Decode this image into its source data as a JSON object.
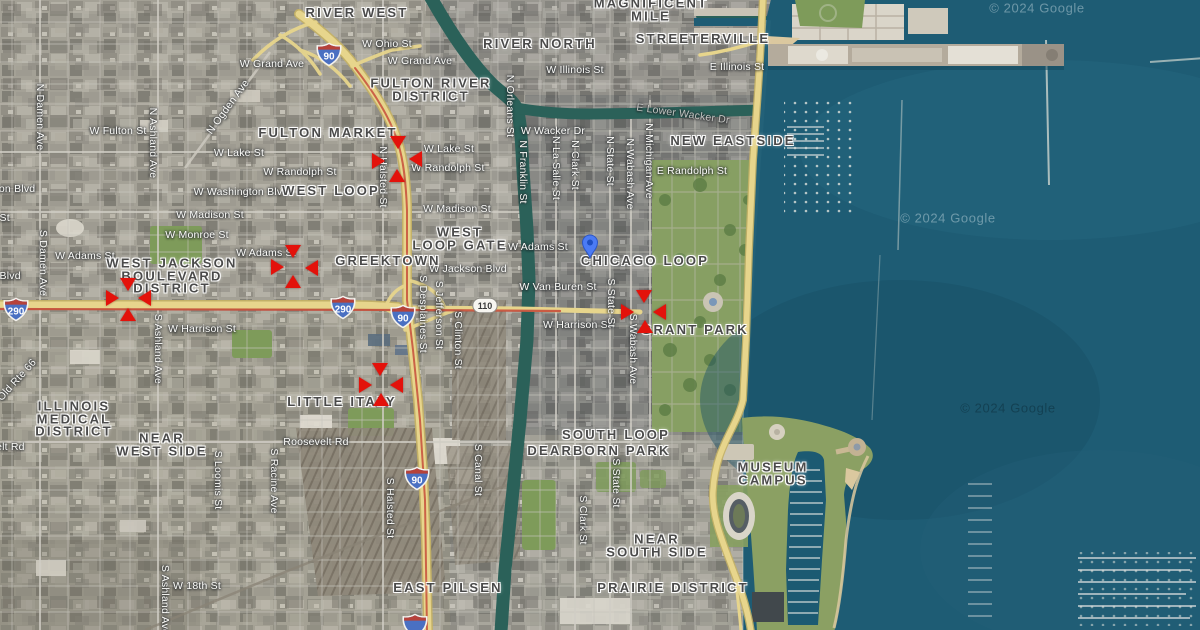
{
  "map": {
    "marker_color": "#e3120b",
    "pin": {
      "x": 590,
      "y": 258,
      "color": "#4b7bf5"
    },
    "watermarks": [
      {
        "text": "© 2024 Google",
        "x": 948,
        "y": 218,
        "tone": "light"
      },
      {
        "text": "© 2024 Google",
        "x": 1008,
        "y": 408,
        "tone": "dark"
      },
      {
        "text": "© 2024 Google",
        "x": 1037,
        "y": 8,
        "tone": "light"
      }
    ],
    "neighborhoods": [
      {
        "lines": [
          "RIVER WEST"
        ],
        "x": 357,
        "y": 13
      },
      {
        "lines": [
          "MAGNIFICENT",
          "MILE"
        ],
        "x": 651,
        "y": 10
      },
      {
        "lines": [
          "RIVER NORTH"
        ],
        "x": 540,
        "y": 44
      },
      {
        "lines": [
          "STREETERVILLE"
        ],
        "x": 703,
        "y": 39
      },
      {
        "lines": [
          "FULTON RIVER",
          "DISTRICT"
        ],
        "x": 431,
        "y": 90
      },
      {
        "lines": [
          "FULTON MARKET"
        ],
        "x": 328,
        "y": 133
      },
      {
        "lines": [
          "NEW EASTSIDE"
        ],
        "x": 733,
        "y": 141
      },
      {
        "lines": [
          "WEST LOOP"
        ],
        "x": 331,
        "y": 191
      },
      {
        "lines": [
          "WEST",
          "LOOP GATE"
        ],
        "x": 460,
        "y": 239
      },
      {
        "lines": [
          "CHICAGO LOOP"
        ],
        "x": 645,
        "y": 261
      },
      {
        "lines": [
          "GREEKTOWN"
        ],
        "x": 388,
        "y": 261
      },
      {
        "lines": [
          "WEST JACKSON",
          "BOULEVARD",
          "DISTRICT"
        ],
        "x": 172,
        "y": 276
      },
      {
        "lines": [
          "GRANT PARK"
        ],
        "x": 695,
        "y": 330
      },
      {
        "lines": [
          "ILLINOIS",
          "MEDICAL",
          "DISTRICT"
        ],
        "x": 74,
        "y": 419
      },
      {
        "lines": [
          "NEAR",
          "WEST SIDE"
        ],
        "x": 162,
        "y": 445
      },
      {
        "lines": [
          "LITTLE ITALY"
        ],
        "x": 342,
        "y": 402
      },
      {
        "lines": [
          "SOUTH LOOP"
        ],
        "x": 616,
        "y": 435
      },
      {
        "lines": [
          "DEARBORN PARK"
        ],
        "x": 599,
        "y": 451
      },
      {
        "lines": [
          "MUSEUM",
          "CAMPUS"
        ],
        "x": 773,
        "y": 474
      },
      {
        "lines": [
          "NEAR",
          "SOUTH SIDE"
        ],
        "x": 657,
        "y": 546
      },
      {
        "lines": [
          "EAST PILSEN"
        ],
        "x": 448,
        "y": 588
      },
      {
        "lines": [
          "PRAIRIE DISTRICT"
        ],
        "x": 673,
        "y": 588
      }
    ],
    "streets": [
      {
        "name": "W Ohio St",
        "x": 387,
        "y": 44
      },
      {
        "name": "W Grand Ave",
        "x": 272,
        "y": 64
      },
      {
        "name": "W Grand Ave",
        "x": 420,
        "y": 61
      },
      {
        "name": "W Illinois St",
        "x": 575,
        "y": 70
      },
      {
        "name": "E Illinois St",
        "x": 737,
        "y": 67
      },
      {
        "name": "W Wacker Dr",
        "x": 553,
        "y": 131
      },
      {
        "name": "E Lower Wacker Dr",
        "x": 683,
        "y": 114,
        "rot": 8,
        "dim": true
      },
      {
        "name": "E Randolph St",
        "x": 692,
        "y": 171
      },
      {
        "name": "W Fulton St",
        "x": 118,
        "y": 131
      },
      {
        "name": "W Lake St",
        "x": 239,
        "y": 153
      },
      {
        "name": "W Lake St",
        "x": 449,
        "y": 149
      },
      {
        "name": "W Randolph St",
        "x": 300,
        "y": 172
      },
      {
        "name": "W Randolph St",
        "x": 448,
        "y": 168
      },
      {
        "name": "W Washington Blvd",
        "x": 241,
        "y": 192
      },
      {
        "name": "W Washington Blvd",
        "x": -12,
        "y": 189
      },
      {
        "name": "W Madison St",
        "x": 210,
        "y": 215
      },
      {
        "name": "W Madison St",
        "x": 457,
        "y": 209
      },
      {
        "name": "W Madison St",
        "x": -24,
        "y": 218
      },
      {
        "name": "W Monroe St",
        "x": 197,
        "y": 235
      },
      {
        "name": "W Adams St",
        "x": 85,
        "y": 256
      },
      {
        "name": "W Adams St",
        "x": 266,
        "y": 253
      },
      {
        "name": "W Adams St",
        "x": 538,
        "y": 247
      },
      {
        "name": "W Jackson Blvd",
        "x": 468,
        "y": 269
      },
      {
        "name": "W Jackson Blvd",
        "x": -18,
        "y": 276
      },
      {
        "name": "W Van Buren St",
        "x": 558,
        "y": 287
      },
      {
        "name": "W Harrison St",
        "x": 202,
        "y": 329
      },
      {
        "name": "W Harrison St",
        "x": 577,
        "y": 325
      },
      {
        "name": "Roosevelt Rd",
        "x": 316,
        "y": 442
      },
      {
        "name": "Roosevelt Rd",
        "x": -8,
        "y": 447
      },
      {
        "name": "W 18th St",
        "x": 197,
        "y": 586
      },
      {
        "name": "N Damen Ave",
        "x": 40,
        "y": 117,
        "rot": 90
      },
      {
        "name": "S Damen Ave",
        "x": 43,
        "y": 263,
        "rot": 90
      },
      {
        "name": "N Ashland Ave",
        "x": 153,
        "y": 143,
        "rot": 90
      },
      {
        "name": "S Ashland Ave",
        "x": 158,
        "y": 349,
        "rot": 90
      },
      {
        "name": "S Ashland Ave",
        "x": 165,
        "y": 600,
        "rot": 90
      },
      {
        "name": "S Loomis St",
        "x": 218,
        "y": 480,
        "rot": 90
      },
      {
        "name": "S Racine Ave",
        "x": 274,
        "y": 481,
        "rot": 90
      },
      {
        "name": "N Halsted St",
        "x": 383,
        "y": 177,
        "rot": 90
      },
      {
        "name": "S Halsted St",
        "x": 390,
        "y": 508,
        "rot": 90
      },
      {
        "name": "S Desplaines St",
        "x": 423,
        "y": 314,
        "rot": 90
      },
      {
        "name": "S Jefferson St",
        "x": 439,
        "y": 315,
        "rot": 90
      },
      {
        "name": "S Clinton St",
        "x": 458,
        "y": 340,
        "rot": 90
      },
      {
        "name": "S Canal St",
        "x": 478,
        "y": 470,
        "rot": 90
      },
      {
        "name": "N Orleans St",
        "x": 510,
        "y": 106,
        "rot": 90
      },
      {
        "name": "N Franklin St",
        "x": 523,
        "y": 172,
        "rot": 90
      },
      {
        "name": "N La Salle St",
        "x": 556,
        "y": 168,
        "rot": 90
      },
      {
        "name": "N Clark St",
        "x": 575,
        "y": 165,
        "rot": 90
      },
      {
        "name": "N State St",
        "x": 610,
        "y": 161,
        "rot": 90
      },
      {
        "name": "N Wabash Ave",
        "x": 630,
        "y": 174,
        "rot": 90
      },
      {
        "name": "N Michigan Ave",
        "x": 649,
        "y": 161,
        "rot": 90
      },
      {
        "name": "S State St",
        "x": 611,
        "y": 303,
        "rot": 90
      },
      {
        "name": "S Wabash Ave",
        "x": 633,
        "y": 349,
        "rot": 90
      },
      {
        "name": "S State St",
        "x": 616,
        "y": 483,
        "rot": 90
      },
      {
        "name": "S Clark St",
        "x": 583,
        "y": 520,
        "rot": 90
      },
      {
        "name": "N Ogden Ave",
        "x": 228,
        "y": 107,
        "rot": -54
      },
      {
        "name": "Old Rte 66",
        "x": 17,
        "y": 380,
        "rot": -48
      }
    ],
    "highway_shields": [
      {
        "type": "interstate",
        "label": "90",
        "x": 329,
        "y": 57
      },
      {
        "type": "interstate",
        "label": "290",
        "x": 16,
        "y": 312
      },
      {
        "type": "interstate",
        "label": "290",
        "x": 343,
        "y": 310
      },
      {
        "type": "interstate",
        "label": "90",
        "x": 403,
        "y": 319
      },
      {
        "type": "state",
        "label": "110",
        "x": 485,
        "y": 308
      },
      {
        "type": "interstate",
        "label": "90",
        "x": 417,
        "y": 481
      },
      {
        "type": "interstate",
        "label": "",
        "x": 415,
        "y": 628
      }
    ],
    "incident_markers": [
      {
        "x": 398,
        "y": 143,
        "dir": "down"
      },
      {
        "x": 379,
        "y": 161,
        "dir": "right"
      },
      {
        "x": 416,
        "y": 159,
        "dir": "left"
      },
      {
        "x": 397,
        "y": 176,
        "dir": "up"
      },
      {
        "x": 293,
        "y": 252,
        "dir": "down"
      },
      {
        "x": 278,
        "y": 267,
        "dir": "right"
      },
      {
        "x": 312,
        "y": 268,
        "dir": "left"
      },
      {
        "x": 293,
        "y": 282,
        "dir": "up"
      },
      {
        "x": 128,
        "y": 285,
        "dir": "down"
      },
      {
        "x": 113,
        "y": 298,
        "dir": "right"
      },
      {
        "x": 145,
        "y": 298,
        "dir": "left"
      },
      {
        "x": 128,
        "y": 315,
        "dir": "up"
      },
      {
        "x": 380,
        "y": 370,
        "dir": "down"
      },
      {
        "x": 366,
        "y": 385,
        "dir": "right"
      },
      {
        "x": 397,
        "y": 385,
        "dir": "left"
      },
      {
        "x": 381,
        "y": 400,
        "dir": "up"
      },
      {
        "x": 644,
        "y": 297,
        "dir": "down"
      },
      {
        "x": 628,
        "y": 312,
        "dir": "right"
      },
      {
        "x": 660,
        "y": 312,
        "dir": "left"
      },
      {
        "x": 645,
        "y": 327,
        "dir": "up"
      }
    ]
  }
}
